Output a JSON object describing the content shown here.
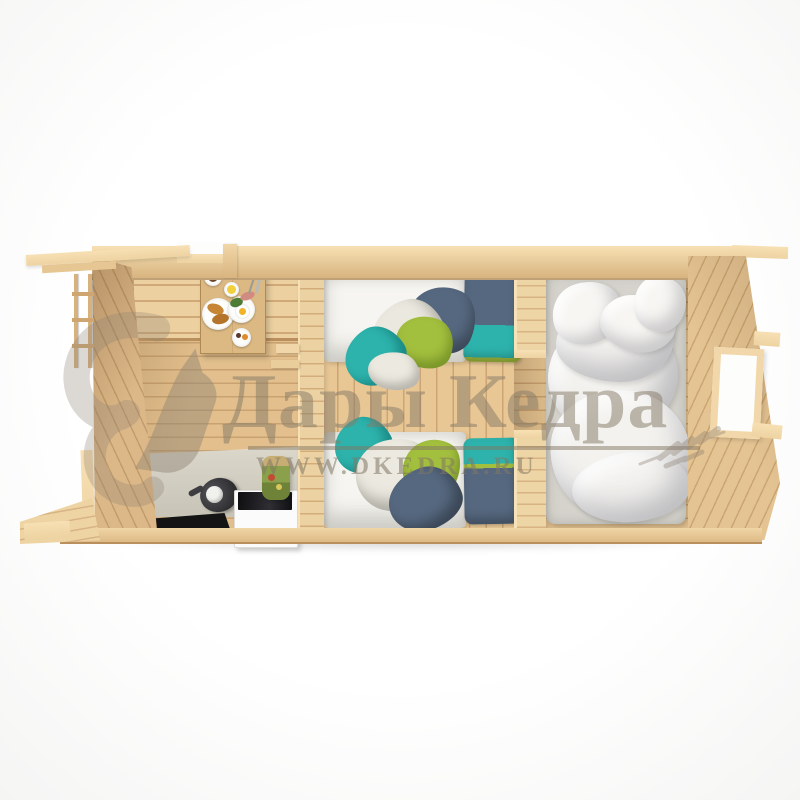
{
  "watermark": {
    "brand": "Дары Кедра",
    "website": "WWW.DKEDRA.RU",
    "logo": "squirrel-icon",
    "decoration": "cedar-branch-icon",
    "color": "#86786a"
  },
  "scene": {
    "description": "Top-down cutaway 3D render of a three-room wooden log cabin",
    "background": "#ffffff",
    "rooms": [
      {
        "name": "kitchen-dining-room",
        "items": [
          "corner-bench",
          "dining-table",
          "breakfast-plates",
          "coffee-cups",
          "croissants",
          "fried-egg",
          "lemon",
          "greens",
          "kitchen-counter",
          "kettle",
          "cooker-cabinet",
          "black-cooktop",
          "preserve-jar",
          "black-floor-mat"
        ]
      },
      {
        "name": "twin-bedroom",
        "items": [
          "single-bed-upper",
          "single-bed-lower",
          "white-mattresses",
          "navy-teal-pillows",
          "teal-green-blankets"
        ]
      },
      {
        "name": "master-bedroom",
        "items": [
          "double-bed",
          "white-duvet",
          "white-pillows",
          "side-window"
        ]
      }
    ],
    "exterior": [
      "roof-overhang-left",
      "ladder-left",
      "top-wall-window",
      "right-wall-window",
      "bottom-left-porch"
    ]
  },
  "palette": {
    "wood_rim": "#f3d9aa",
    "wood_mid": "#e6c492",
    "wood_dark": "#c9a271",
    "counter_gray": "#cfccc0",
    "appliance_white": "#fbfbfb",
    "cooktop_black": "#1c1c1f",
    "mat_black": "#141414",
    "pillow_teal": "#2db3ac",
    "pillow_navy": "#56687f",
    "blanket_green": "#a3bf3e",
    "bedding_white": "#f3f2ef",
    "watermark_tan": "#86786a"
  }
}
